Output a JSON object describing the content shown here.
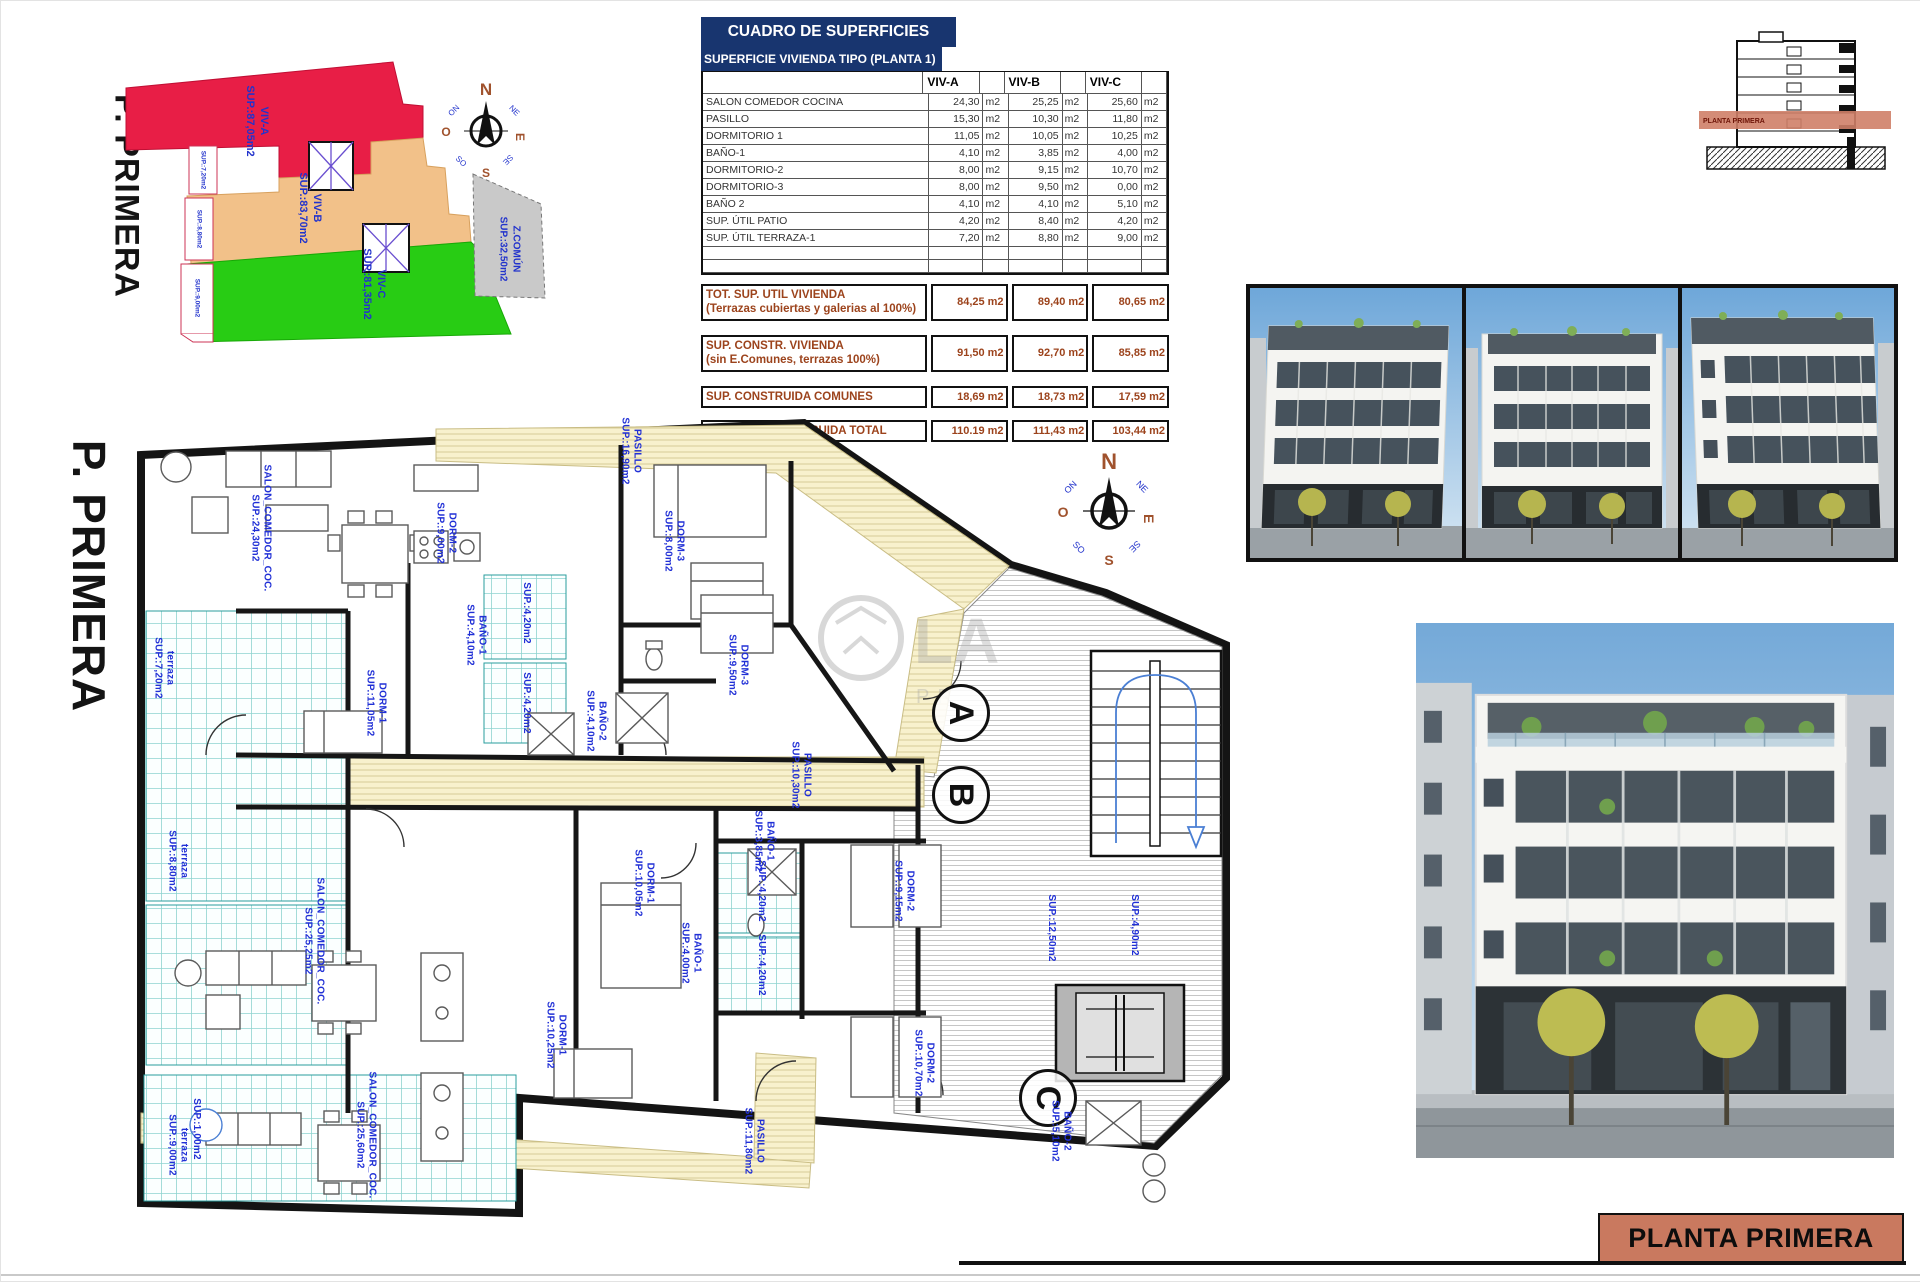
{
  "key_plan": {
    "floor_label": "P. PRIMERA",
    "zones": [
      {
        "id": "viv-a",
        "label": "VIV-A\nSUP.:87,05m2",
        "color": "#e81e46"
      },
      {
        "id": "viv-b",
        "label": "VIV-B\nSUP.:83,70m2",
        "color": "#f2c189"
      },
      {
        "id": "viv-c",
        "label": "VIV-C\nSUP.:81,35m2",
        "color": "#28cc14"
      },
      {
        "id": "z-comun",
        "label": "Z.COMÚN\nSUP.:32,50m2",
        "color": "#c9c9c9"
      }
    ],
    "strip_labels": [
      "SUP.:7,20m2",
      "SUP.:8,80m2",
      "SUP.:9,00m2"
    ]
  },
  "compass": {
    "cardinals": [
      "N",
      "E",
      "S",
      "O"
    ],
    "intercardinals": [
      "NE",
      "SE",
      "SO",
      "NO"
    ]
  },
  "surface_table": {
    "title": "CUADRO DE SUPERFICIES",
    "subtitle": "SUPERFICIE VIVIENDA TIPO  (PLANTA 1)",
    "columns": [
      "VIV-A",
      "VIV-B",
      "VIV-C"
    ],
    "unit": "m2",
    "rows": [
      {
        "label": "SALON COMEDOR COCINA",
        "a": "24,30",
        "b": "25,25",
        "c": "25,60"
      },
      {
        "label": "PASILLO",
        "a": "15,30",
        "b": "10,30",
        "c": "11,80"
      },
      {
        "label": "DORMITORIO 1",
        "a": "11,05",
        "b": "10,05",
        "c": "10,25"
      },
      {
        "label": "BAÑO-1",
        "a": "4,10",
        "b": "3,85",
        "c": "4,00"
      },
      {
        "label": "DORMITORIO-2",
        "a": "8,00",
        "b": "9,15",
        "c": "10,70"
      },
      {
        "label": "DORMITORIO-3",
        "a": "8,00",
        "b": "9,50",
        "c": "0,00"
      },
      {
        "label": "BAÑO 2",
        "a": "4,10",
        "b": "4,10",
        "c": "5,10"
      },
      {
        "label": "SUP. ÚTIL PATIO",
        "a": "4,20",
        "b": "8,40",
        "c": "4,20"
      },
      {
        "label": "SUP. ÚTIL TERRAZA-1",
        "a": "7,20",
        "b": "8,80",
        "c": "9,00"
      }
    ],
    "summary": [
      {
        "label": "TOT. SUP. UTIL VIVIENDA",
        "sublabel": "(Terrazas cubiertas y galerias al 100%)",
        "a": "84,25",
        "b": "89,40",
        "c": "80,65"
      },
      {
        "label": "SUP. CONSTR. VIVIENDA",
        "sublabel": "(sin E.Comunes, terrazas 100%)",
        "a": "91,50",
        "b": "92,70",
        "c": "85,85"
      },
      {
        "label": "SUP. CONSTRUIDA COMUNES",
        "a": "18,69",
        "b": "18,73",
        "c": "17,59"
      },
      {
        "label": "SUPERFIIE CONSTRUIDA TOTAL",
        "a": "110.19",
        "b": "111,43",
        "c": "103,44"
      }
    ]
  },
  "section_thumb": {
    "band_label": "PLANTA PRIMERA"
  },
  "floor_plan": {
    "floor_label": "P. PRIMERA",
    "markers": [
      "A",
      "B",
      "C"
    ],
    "watermark": {
      "big": "LA",
      "small": "PR"
    },
    "labels": [
      "SALON_COMEDOR_COC.\nSUP.:24,30m2",
      "DORM-2\nSUP.:9,00m2",
      "DORM-3\nSUP.:8,00m2",
      "PASILLO\nSUP.:16,90m2",
      "DORM-1\nSUP.:11,05m2",
      "BAÑO-1\nSUP.:4,10m2",
      "BAÑO-2\nSUP.:4,10m2",
      "terraza\nSUP.:7,20m2",
      "SUP.:4,20m2",
      "SUP.:4,20m2",
      "SALON_COMEDOR_COC.\nSUP.:25,25m2",
      "DORM-1\nSUP.:10,05m2",
      "DORM-3\nSUP.:9,50m2",
      "DORM-2\nSUP.:9,15m2",
      "BAÑO-1\nSUP.:3,85m2",
      "PASILLO\nSUP.:10,30m2",
      "terraza\nSUP.:8,80m2",
      "SUP.:4,20m2",
      "SUP.:4,20m2",
      "SALON_COMEDOR_COC.\nSUP.:25,60m2",
      "DORM-1\nSUP.:10,25m2",
      "DORM-2\nSUP.:10,70m2",
      "BAÑO-2\nSUP.:5,10m2",
      "terraza\nSUP.:9,00m2",
      "PASILLO\nSUP.:11,80m2",
      "BAÑO-1\nSUP.:4,00m2",
      "SUP.:12,50m2",
      "SUP.:4,90m2",
      "SUP.:1,00m2"
    ]
  },
  "title_block": {
    "text": "PLANTA PRIMERA"
  }
}
